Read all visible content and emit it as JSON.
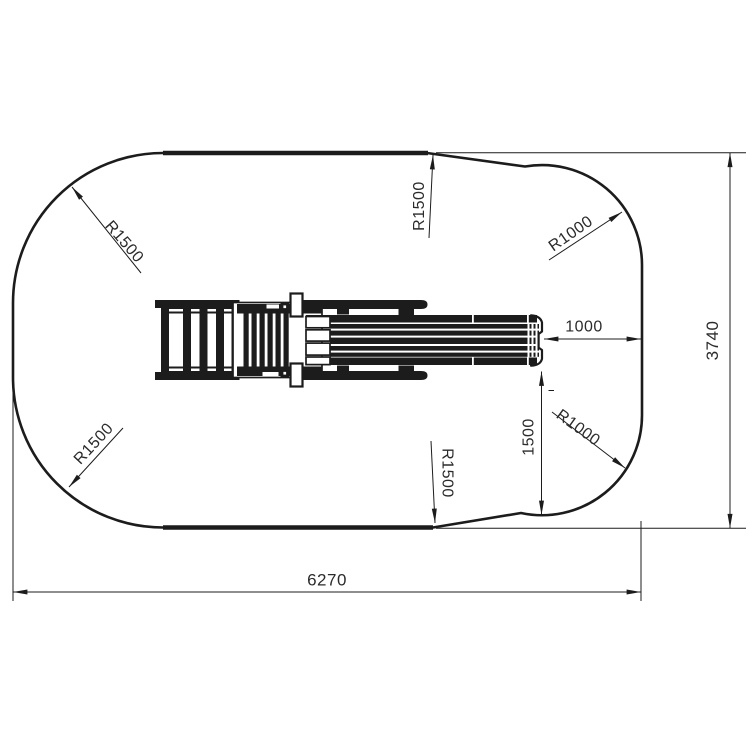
{
  "drawing": {
    "colors": {
      "line": "#1c1c1c",
      "text": "#2b2b2b",
      "background": "#ffffff"
    },
    "labels": {
      "top_left_radius": "R1500",
      "top_mid_radius": "R1500",
      "top_right_radius": "R1000",
      "end_clearance": "1000",
      "overall_height": "3740",
      "bottom_left_radius": "R1500",
      "bottom_mid_radius": "R1500",
      "bottom_right_radius": "R1000",
      "side_clearance": "1500",
      "overall_width": "6270"
    }
  }
}
